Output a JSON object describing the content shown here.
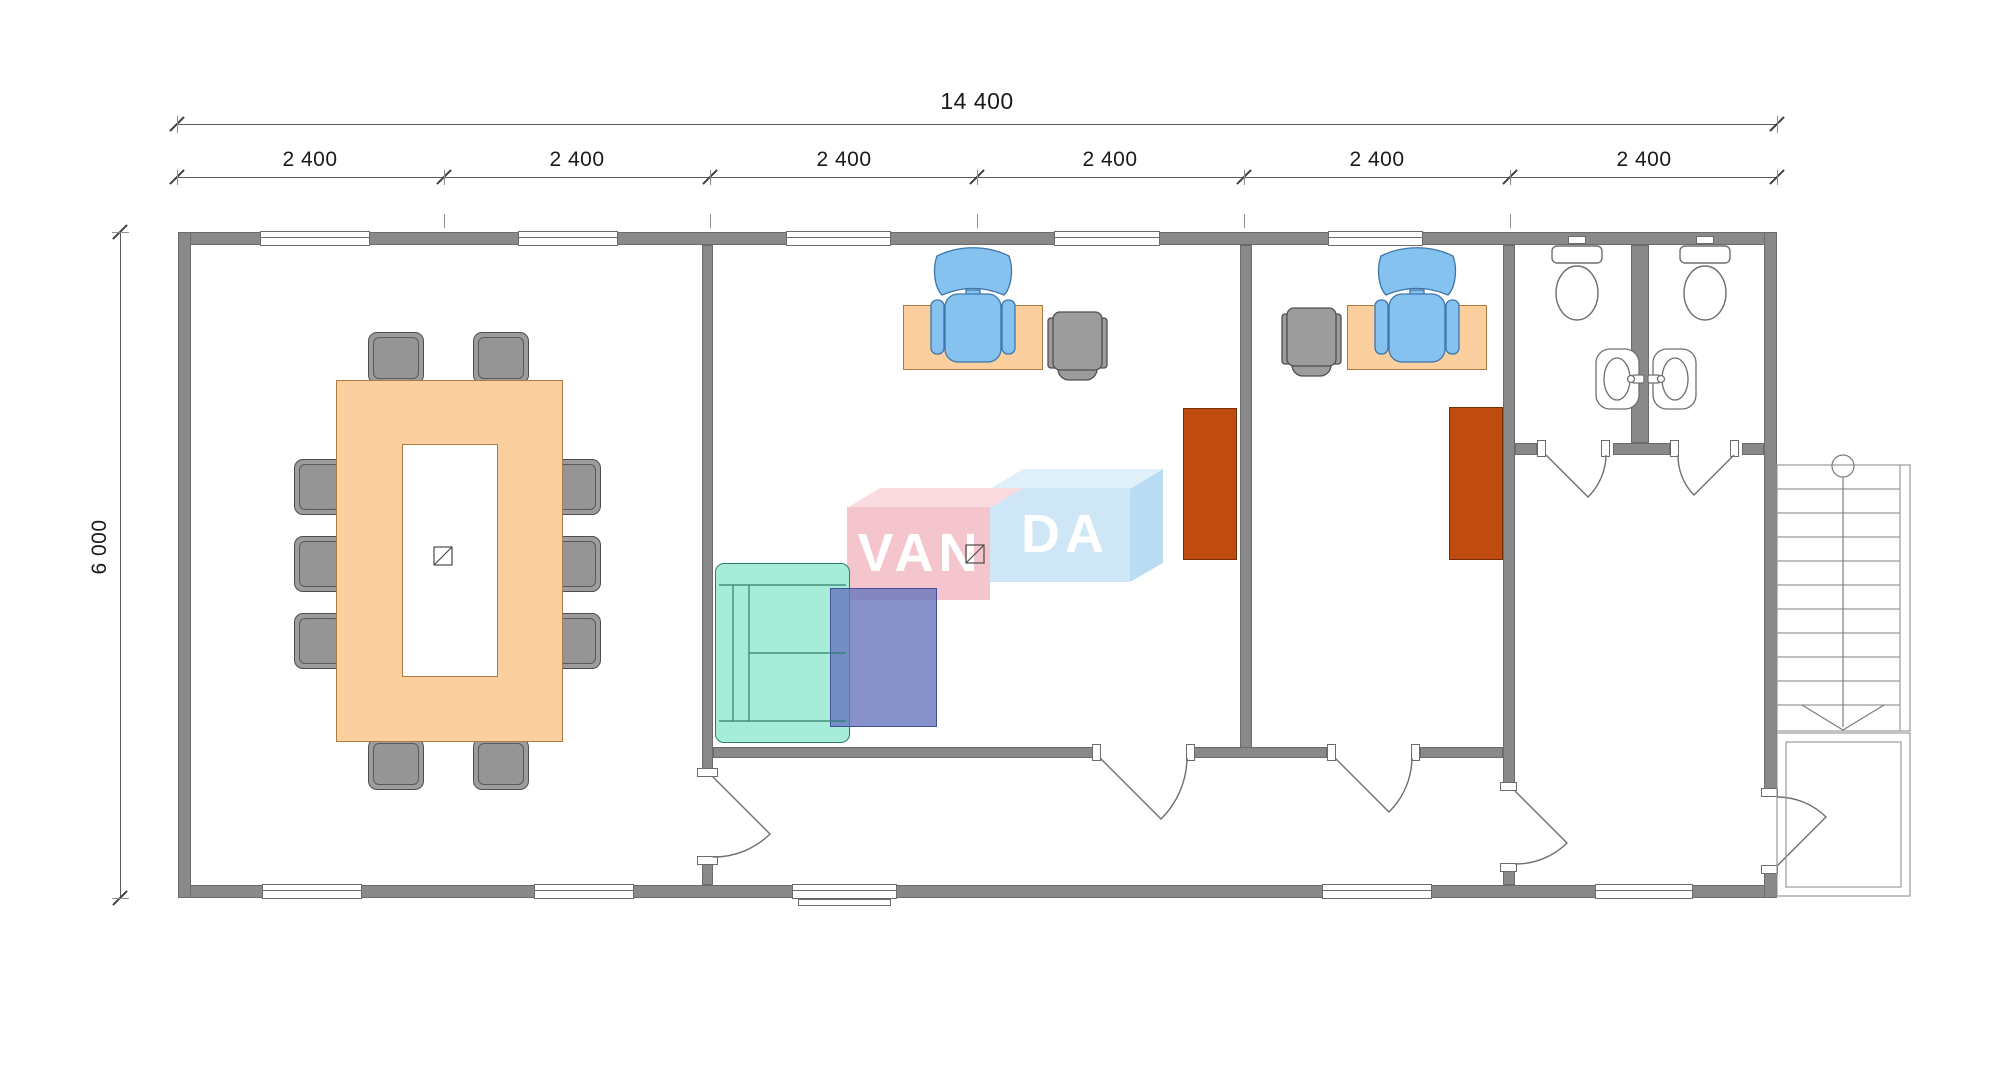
{
  "plan_title": "office floor plan",
  "dimensions": {
    "total_width": "14 400",
    "total_height": "6 000",
    "bays": [
      "2 400",
      "2 400",
      "2 400",
      "2 400",
      "2 400",
      "2 400"
    ]
  },
  "logo": {
    "van": "VAN",
    "da": "DA"
  },
  "colors": {
    "wall": "#898989",
    "furniture_wood": "#FBCF9E",
    "furniture_wood_border": "#AE7A3E",
    "chair_gray": "#9C9C9C",
    "office_chair_blue": "#85C2F0",
    "sofa_teal": "#A7EBD9",
    "cabinet_rust": "#C04B0F",
    "coffee_table_blue": "#6876BD",
    "logo_pink": "#F5C5CD",
    "logo_blue": "#CFE6F7"
  }
}
